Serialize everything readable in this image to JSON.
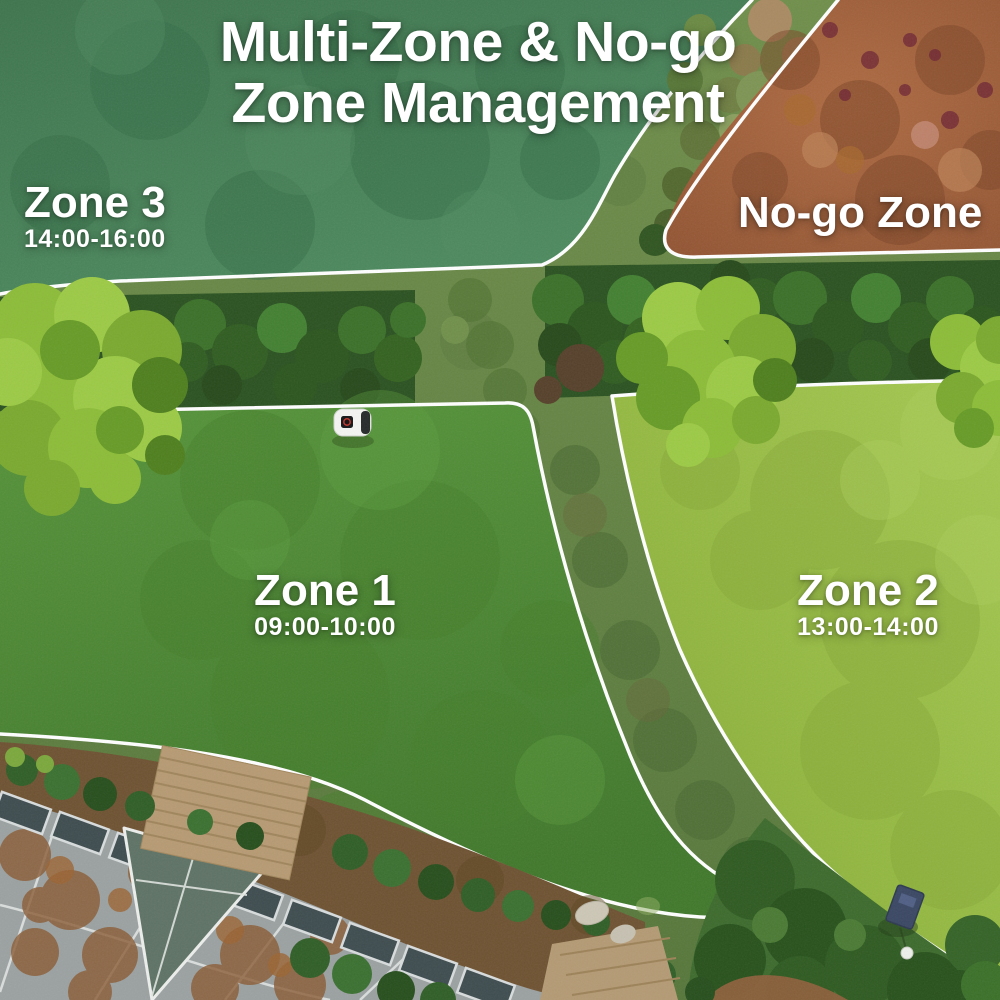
{
  "title": {
    "line1": "Multi-Zone & No-go",
    "line2": "Zone Management"
  },
  "zones": {
    "zone3": {
      "label": "Zone 3",
      "schedule": "14:00-16:00"
    },
    "nogo": {
      "label": "No-go Zone"
    },
    "zone1": {
      "label": "Zone 1",
      "schedule": "09:00-10:00"
    },
    "zone2": {
      "label": "Zone 2",
      "schedule": "13:00-14:00"
    }
  },
  "colors": {
    "boundary_line": "#ffffff",
    "label_text": "#ffffff",
    "zone3_fill": "#487d56",
    "nogo_fill": "#a5683c",
    "zone1_fill": "#4f8832",
    "zone2_fill": "#93b840",
    "hedge_green": "#2a5120",
    "roof_gray": "#9ba1a1"
  },
  "scene_objects": [
    "robot-mower",
    "boundary-line",
    "hedge-row",
    "tree-canopy",
    "no-go-dirt-area",
    "house-roof",
    "glass-atrium",
    "wooden-deck",
    "garden-bushes",
    "blue-box",
    "white-ball",
    "stepping-stones",
    "worn-grass-path"
  ]
}
